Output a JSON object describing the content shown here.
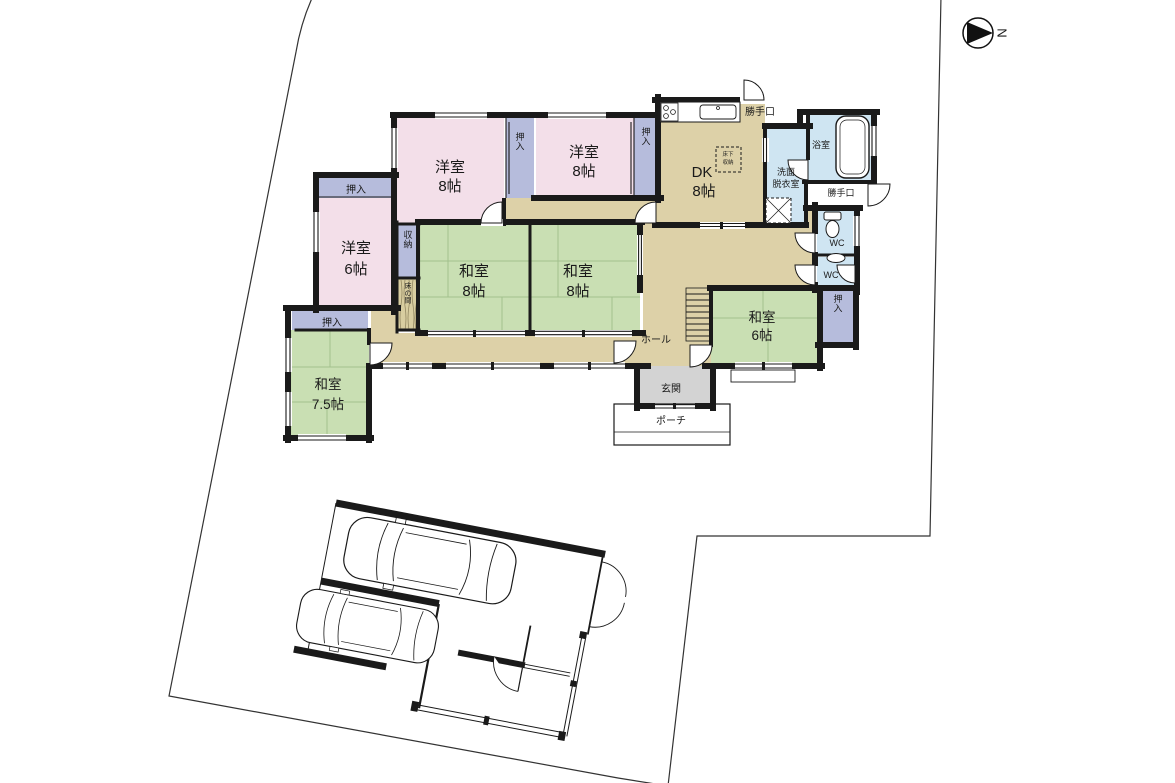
{
  "title": "間取り図",
  "compass": {
    "north_label": "N"
  },
  "colors": {
    "wall": "#1a1a1a",
    "western_room_pink": "#f3dfe9",
    "closet_lavender": "#b6bcdc",
    "tatami_green": "#c9dfb3",
    "tatami_line": "#a3c18e",
    "corridor_tan": "#ddd1a8",
    "wet_area_blue": "#cfe5f2",
    "entrance_gray": "#d3d3d3",
    "tokonoma_tan": "#d8cda0"
  },
  "rooms": {
    "yoshitsu8a": {
      "line1": "洋室",
      "line2": "8帖"
    },
    "yoshitsu8b": {
      "line1": "洋室",
      "line2": "8帖"
    },
    "yoshitsu6": {
      "line1": "洋室",
      "line2": "6帖"
    },
    "washitsu8a": {
      "line1": "和室",
      "line2": "8帖"
    },
    "washitsu8b": {
      "line1": "和室",
      "line2": "8帖"
    },
    "washitsu6": {
      "line1": "和室",
      "line2": "6帖"
    },
    "washitsu75": {
      "line1": "和室",
      "line2": "7.5帖"
    },
    "dk": {
      "line1": "DK",
      "line2": "8帖"
    },
    "senmen": {
      "line1": "洗面",
      "line2": "脱衣室"
    },
    "bath": "浴室",
    "hall": "ホール",
    "genkan": "玄関",
    "porch": "ポーチ",
    "wc1": "WC",
    "wc2": "WC",
    "katteguchi_top": "勝手口",
    "katteguchi_side": "勝手口",
    "oshiire_a": "押入",
    "oshiire_b": "押入",
    "oshiire_y6": "押入",
    "oshiire_w6": "押入",
    "oshiire_w75": "押入",
    "shuno": "収納",
    "tokonoma": "床の間",
    "yukashita": {
      "line1": "床下",
      "line2": "収納"
    }
  }
}
